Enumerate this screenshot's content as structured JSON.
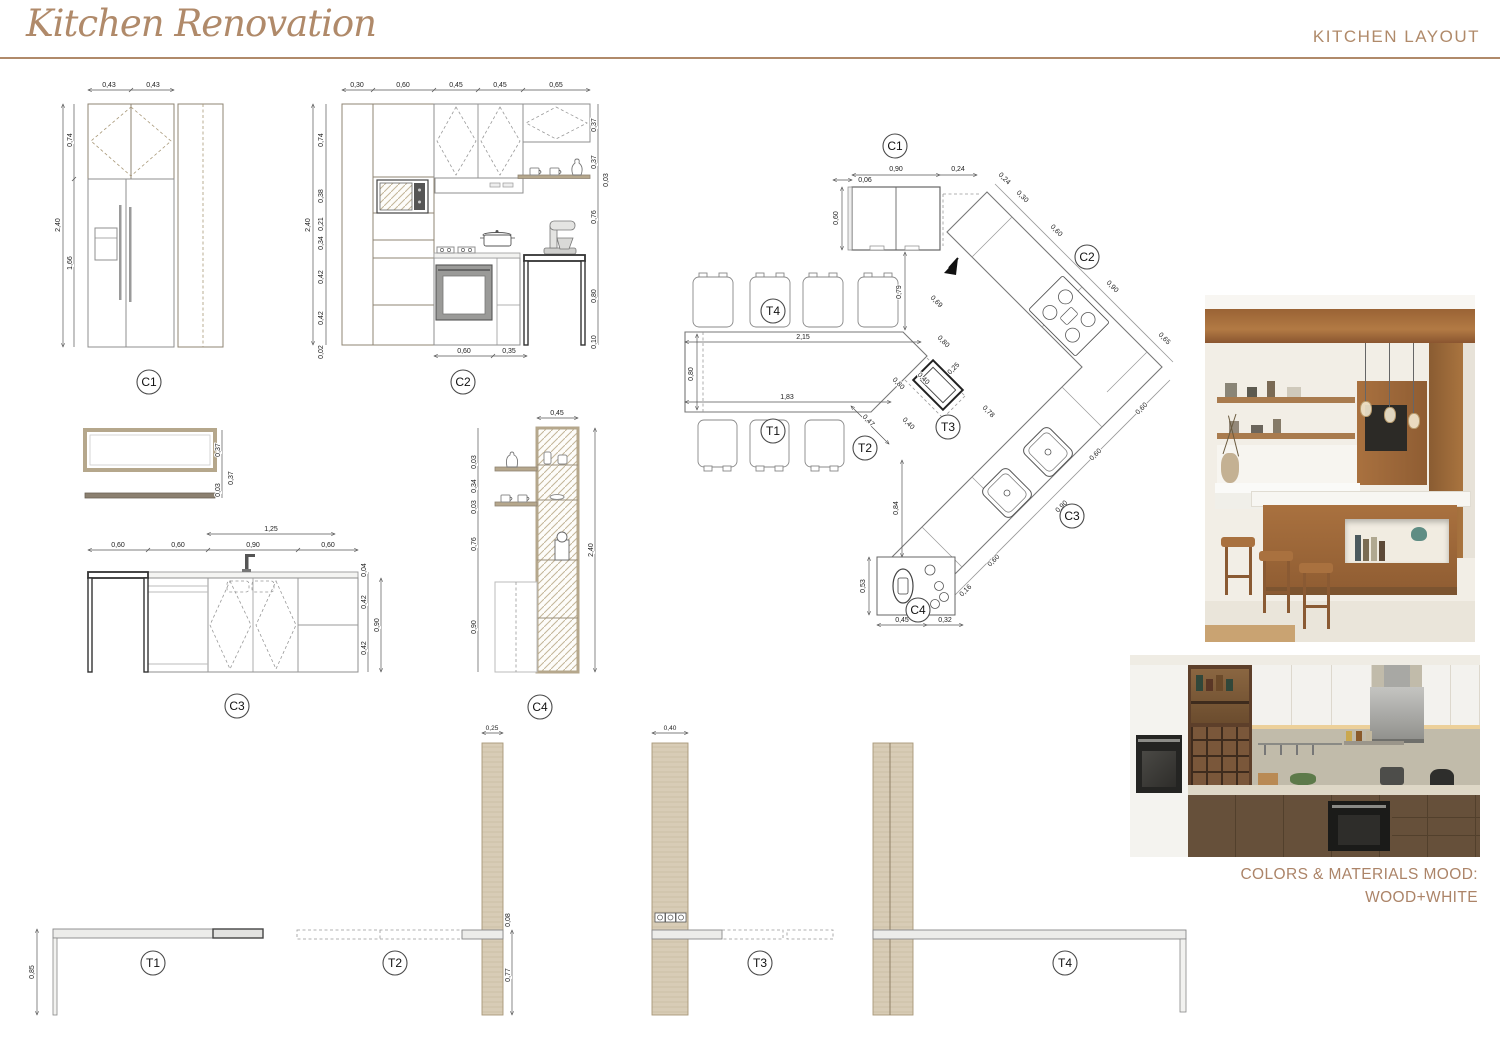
{
  "header": {
    "logo": "Kitchen Renovation",
    "title": "KITCHEN LAYOUT"
  },
  "accent": "#B08A6A",
  "mood": {
    "line1": "COLORS & MATERIALS MOOD:",
    "line2": "WOOD+WHITE"
  },
  "drawings": {
    "c1": {
      "label": "C1",
      "top": [
        "0,43",
        "0,43"
      ],
      "height": "2,40",
      "upper": "0,74",
      "lower": "1,66"
    },
    "c2": {
      "label": "C2",
      "top": [
        "0,30",
        "0,60",
        "0,45",
        "0,45",
        "0,65"
      ],
      "height": "2,40",
      "left": [
        "0,74",
        "0,38",
        "0,21",
        "0,34",
        "0,42",
        "0,42",
        "0,02"
      ],
      "right": [
        "0,37",
        "0,37",
        "0,03",
        "0,76",
        "0,80",
        "0,10"
      ],
      "bottom": [
        "0,60",
        "0,35"
      ]
    },
    "c3": {
      "label": "C3",
      "detail": [
        "0,37",
        "0,37",
        "0,03"
      ],
      "span": "1,25",
      "top": [
        "0,60",
        "0,60",
        "0,90",
        "0,60"
      ],
      "right": [
        "0,04",
        "0,42",
        "0,42"
      ],
      "depth": "0,90"
    },
    "c4": {
      "label": "C4",
      "top": "0,45",
      "left": [
        "0,03",
        "0,34",
        "0,03",
        "0,76",
        "0,90"
      ],
      "height": "2,40"
    },
    "t1": {
      "label": "T1",
      "height": "0,85"
    },
    "t2": {
      "label": "T2",
      "width": "0,25",
      "top": "0,08",
      "height": "0,77"
    },
    "t3": {
      "label": "T3",
      "width": "0,40"
    },
    "t4": {
      "label": "T4"
    }
  },
  "plan": {
    "tags": {
      "c1": "C1",
      "c2": "C2",
      "c3": "C3",
      "c4": "C4",
      "t1": "T1",
      "t2": "T2",
      "t3": "T3",
      "t4": "T4"
    },
    "dims": {
      "fridge_w": "0,90",
      "gap": "0,24",
      "offset": "0,06",
      "depth": "0,60",
      "drop": "0,79",
      "wall1": "0,24",
      "wall2": "0,30",
      "run1": "0,60",
      "run2": "0,90",
      "run3": "0,65",
      "inner1": "0,69",
      "inner2": "0,80",
      "side1": "0,60",
      "side2": "0,60",
      "side3": "0,60",
      "sink": "0,90",
      "end": "0,16",
      "c4w": "0,45",
      "c4d": "0,32",
      "c4h": "0,53",
      "down": "0,84",
      "t3a": "0,40",
      "t3b": "0,40",
      "t3w": "0,25",
      "t3c": "0,80",
      "t3d": "0,78",
      "t2w": "0,47",
      "table_top": "2,15",
      "table_bot": "1,83",
      "table_w": "0,80"
    }
  }
}
